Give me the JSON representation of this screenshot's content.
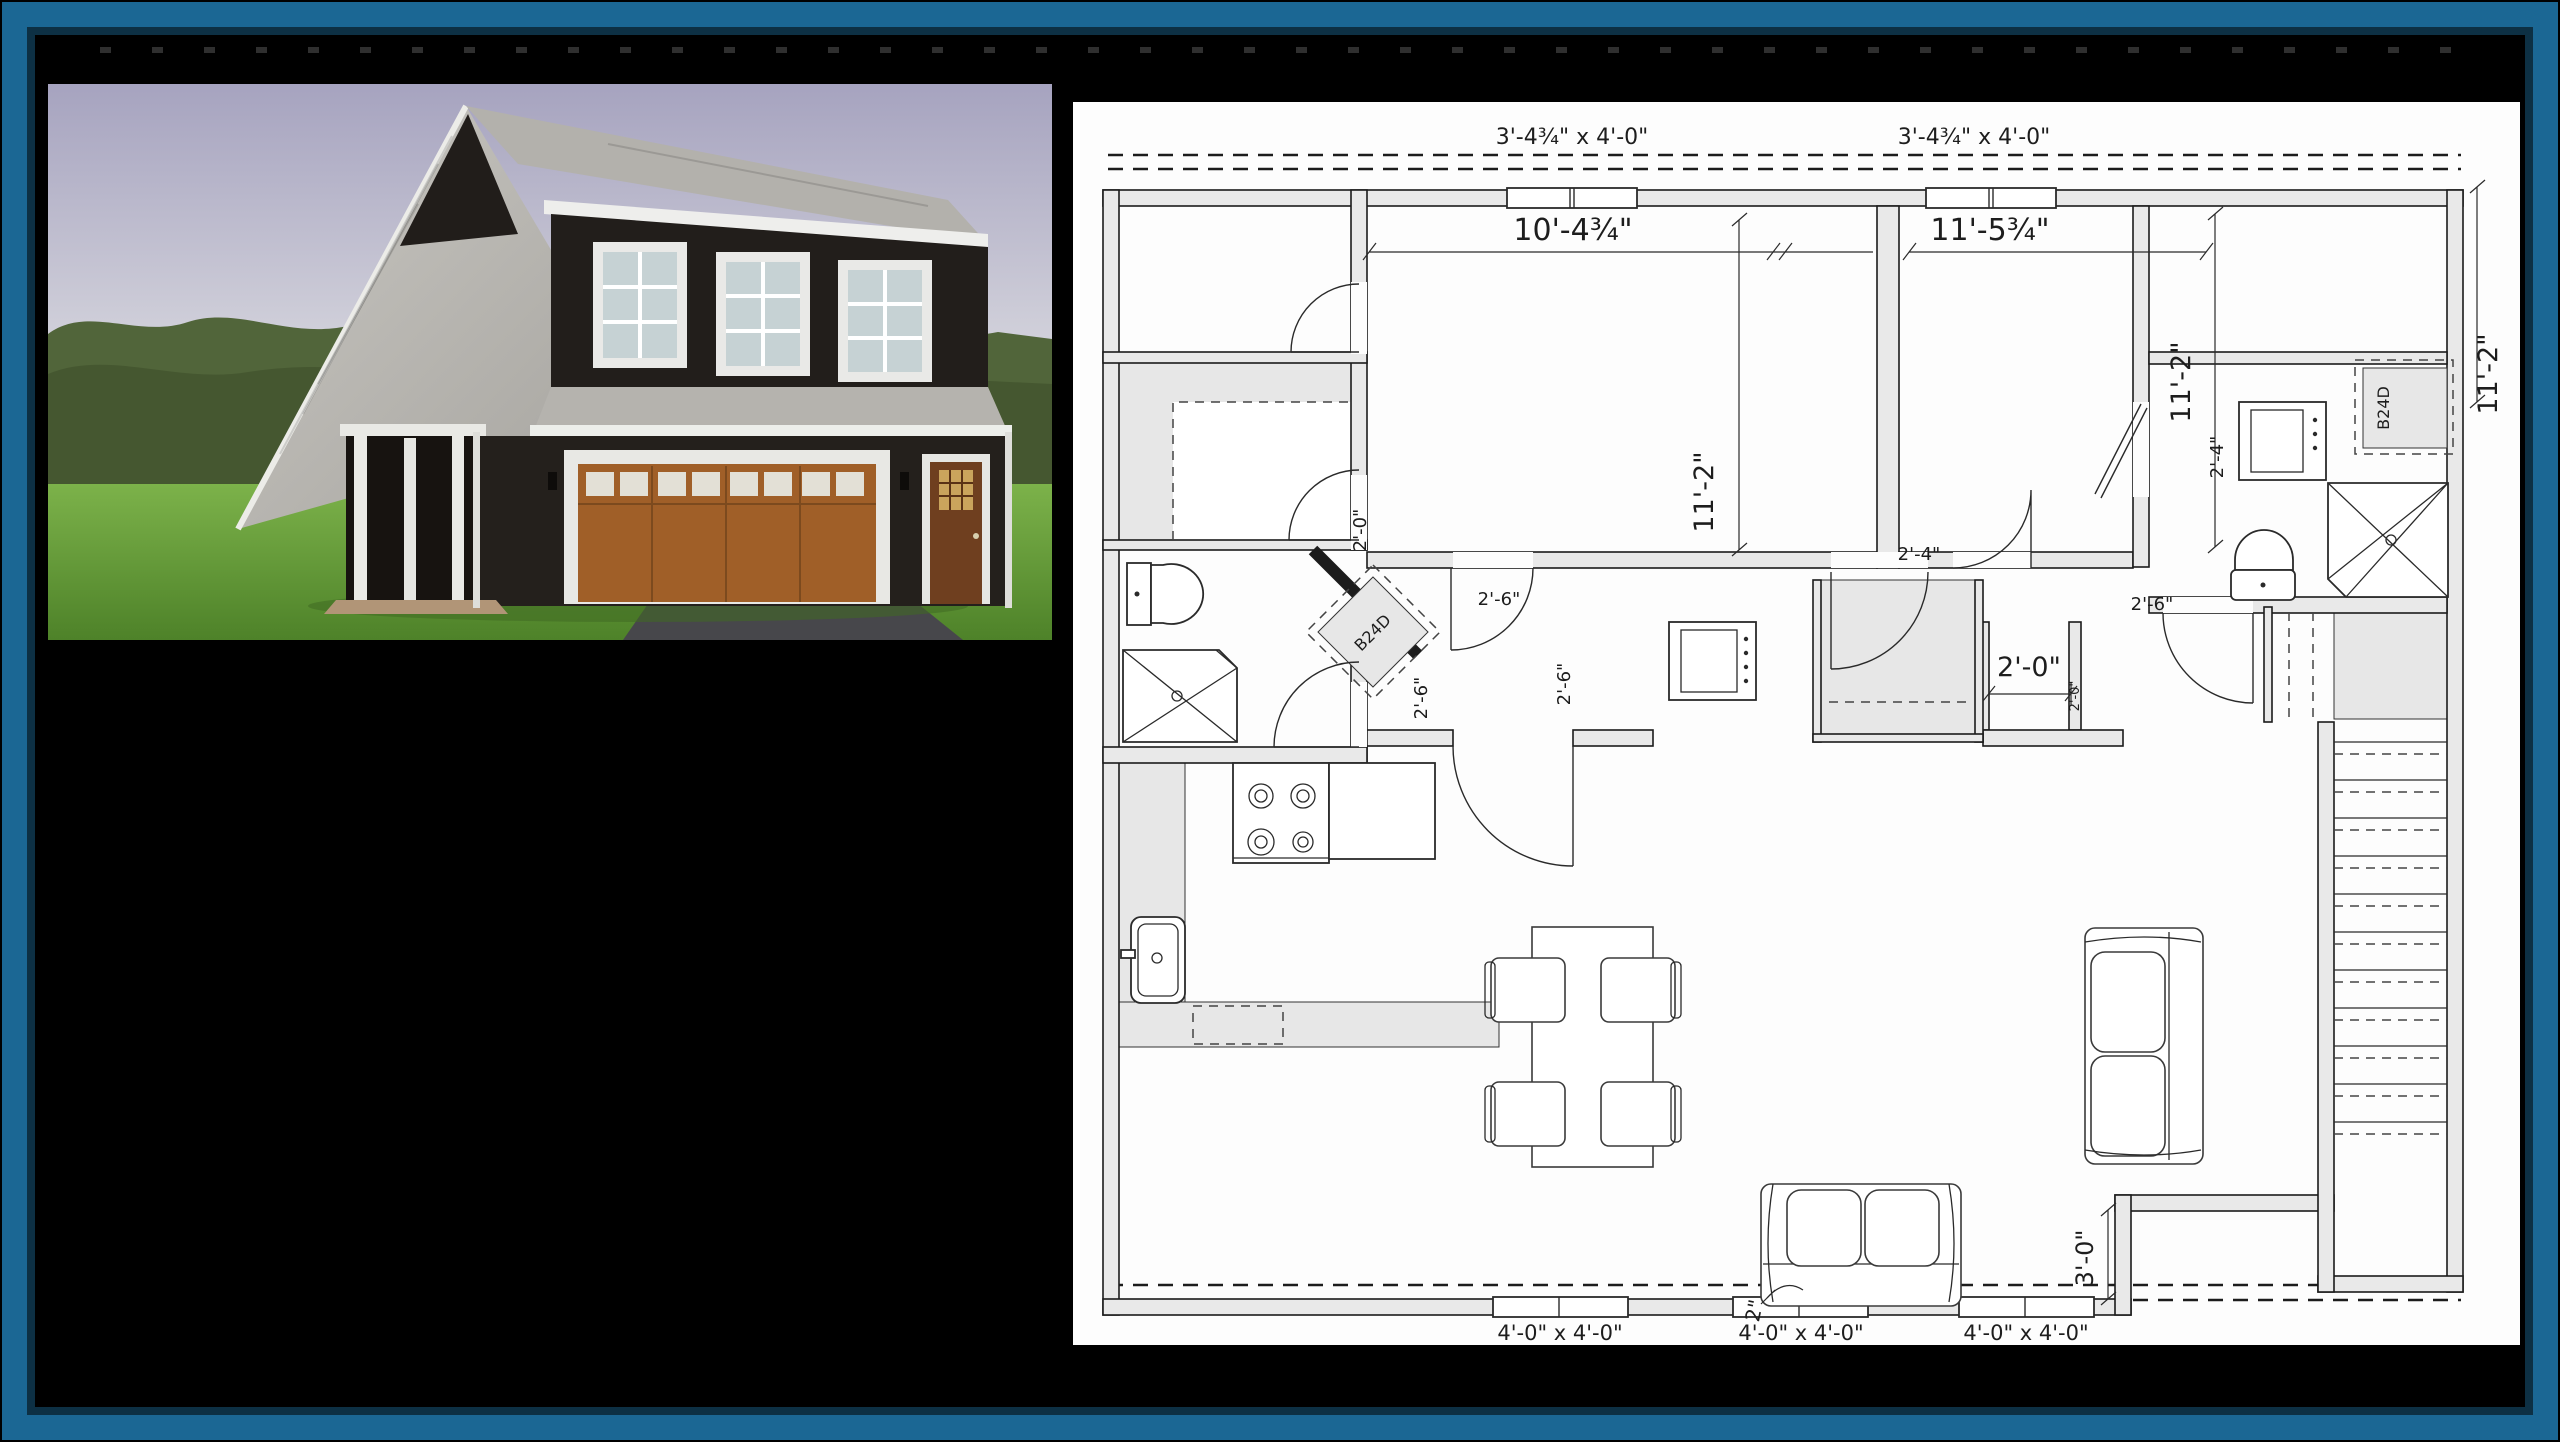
{
  "frame": {
    "teal_border": "#1b6794",
    "navy_inner_edge": "#0d3044",
    "background": "#000000"
  },
  "photo": {
    "description": "3D rendering of a 1.5-story carriage-house garage with dark siding, gray shingle gable roof, shed dormer with three white windows, brown carriage-style garage door, side entry door and a left porch, on a grassy lot with paved driveway and trees behind",
    "sky_color": "#aaa7c1",
    "tree_color": "#4e6134",
    "grass_color": "#6aa43c",
    "driveway_color": "#47474b",
    "siding_color": "#221e1b",
    "roof_color": "#bcbab5",
    "garage_door_color": "#a05f28",
    "trim_color": "#ebebe7"
  },
  "plan": {
    "paper_color": "#fdfdfd",
    "ink_color": "#1d1d1d",
    "wall_fill": "#e9e9e9",
    "dims": [
      {
        "id": "win-top-left",
        "text": "3'-4¾\" x 4'-0\""
      },
      {
        "id": "win-top-right",
        "text": "3'-4¾\" x 4'-0\""
      },
      {
        "id": "bedroom1-width",
        "text": "10'-4¾\""
      },
      {
        "id": "bedroom2-width",
        "text": "11'-5¾\""
      },
      {
        "id": "bedroom1-depth",
        "text": "11'-2\""
      },
      {
        "id": "bedroom2-depth",
        "text": "11'-2\""
      },
      {
        "id": "right-wing-depth",
        "text": "11'-2\""
      },
      {
        "id": "closet-door",
        "text": "2'-0\""
      },
      {
        "id": "hall-closet-door",
        "text": "2'-4\""
      },
      {
        "id": "wing-door",
        "text": "2'-4\""
      },
      {
        "id": "bedroom1-door",
        "text": "2'-6\""
      },
      {
        "id": "bath2-door",
        "text": "2'-6\""
      },
      {
        "id": "bath1-door",
        "text": "2'-6\""
      },
      {
        "id": "kitchen-door",
        "text": "2'-6\""
      },
      {
        "id": "vestibule-width",
        "text": "2'-0\""
      },
      {
        "id": "vestibule-width-small",
        "text": "2'-0\""
      },
      {
        "id": "corner-cabinet-left",
        "text": "B24D"
      },
      {
        "id": "corner-cabinet-right",
        "text": "B24D"
      },
      {
        "id": "corner-jog",
        "text": "3'-0\""
      },
      {
        "id": "sofa-gap",
        "text": "2\""
      },
      {
        "id": "win-bottom-1",
        "text": "4'-0\" x 4'-0\""
      },
      {
        "id": "win-bottom-2",
        "text": "4'-0\" x 4'-0\""
      },
      {
        "id": "win-bottom-3",
        "text": "4'-0\" x 4'-0\""
      }
    ]
  }
}
